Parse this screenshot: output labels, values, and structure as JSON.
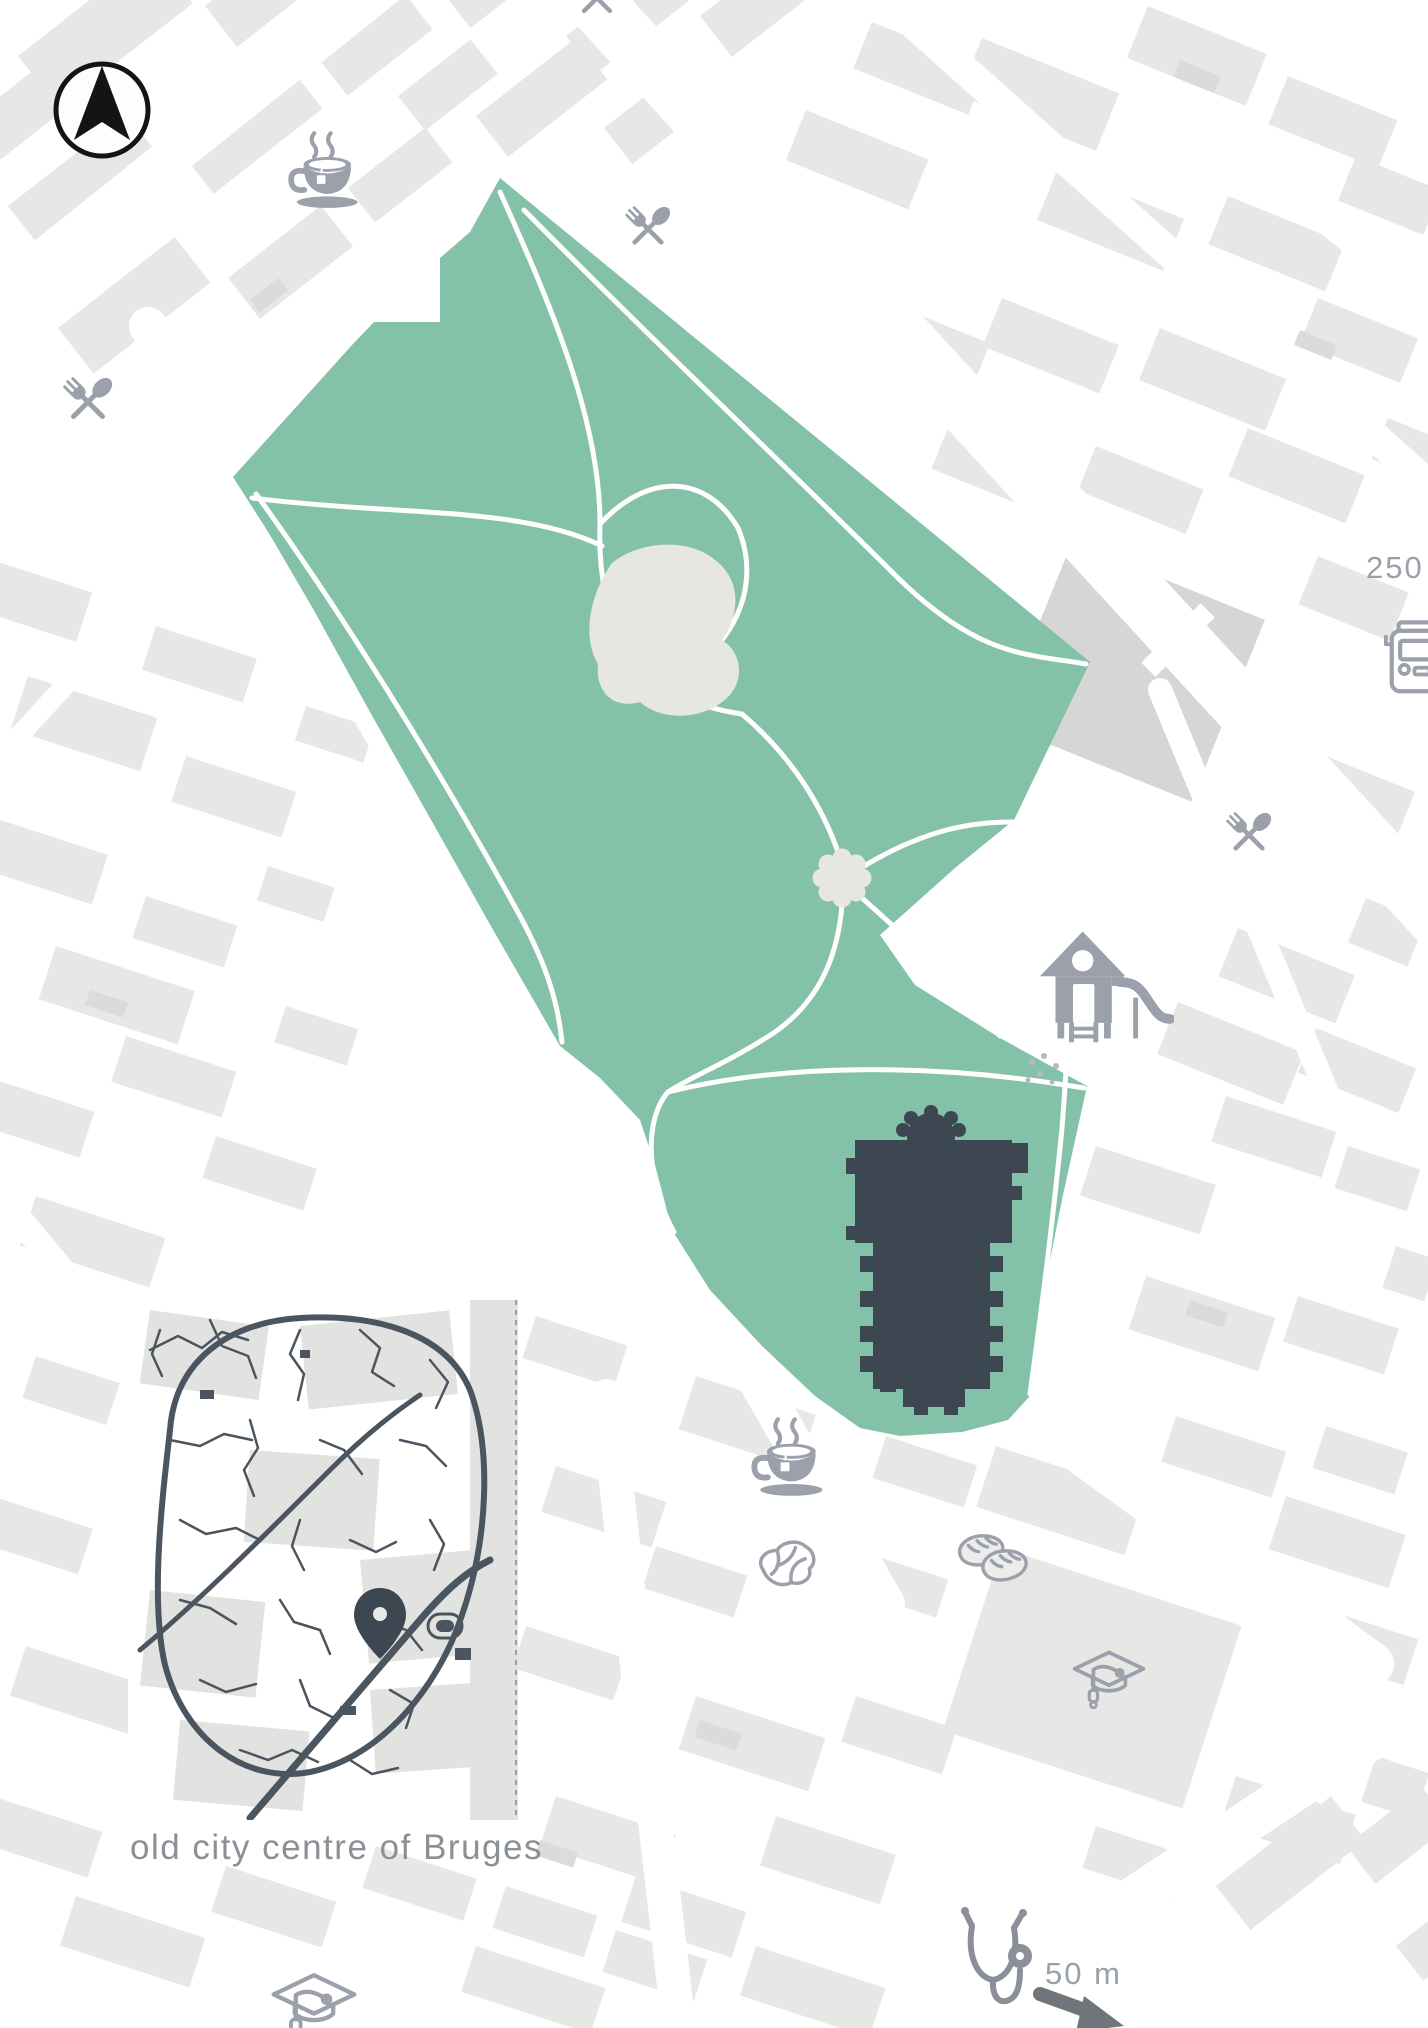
{
  "scale": {
    "top_label": "250 m",
    "bottom_label": "50 m"
  },
  "inset": {
    "caption": "old city centre of Bruges"
  },
  "icons": [
    "compass-north-arrow",
    "tea-cup-north",
    "restaurant-cutlery-top",
    "restaurant-cutlery-left",
    "restaurant-cutlery-right",
    "bus-stop",
    "playground-slide",
    "church-building-footprint",
    "tea-cup-south",
    "butcher-steak",
    "bakery-bread",
    "school-graduation-cap-east",
    "school-graduation-cap-south",
    "pharmacy-stethoscope",
    "location-pin",
    "scale-direction-arrow"
  ],
  "park": {
    "name": "park with pond, rosette plaza and church"
  },
  "colors": {
    "background": "#ffffff",
    "block-gray": "#e7e8e5",
    "block-mid": "#dbdcd9",
    "block-dark-building": "#d6d7d4",
    "park-green": "#84c1a9",
    "pond-gray": "#e6e6e3",
    "building-dark": "#3d4751",
    "icon-gray": "#9ba0ab",
    "inset-street": "#4b5560",
    "inset-patch": "#e2e3e0",
    "loaf-fill": "#ececea",
    "caption-text": "#8b9097",
    "scale-text": "#9aa0a8",
    "compass-black": "#141414",
    "arrow-dark": "#70757c",
    "stetho-gray": "#8a8f99"
  }
}
